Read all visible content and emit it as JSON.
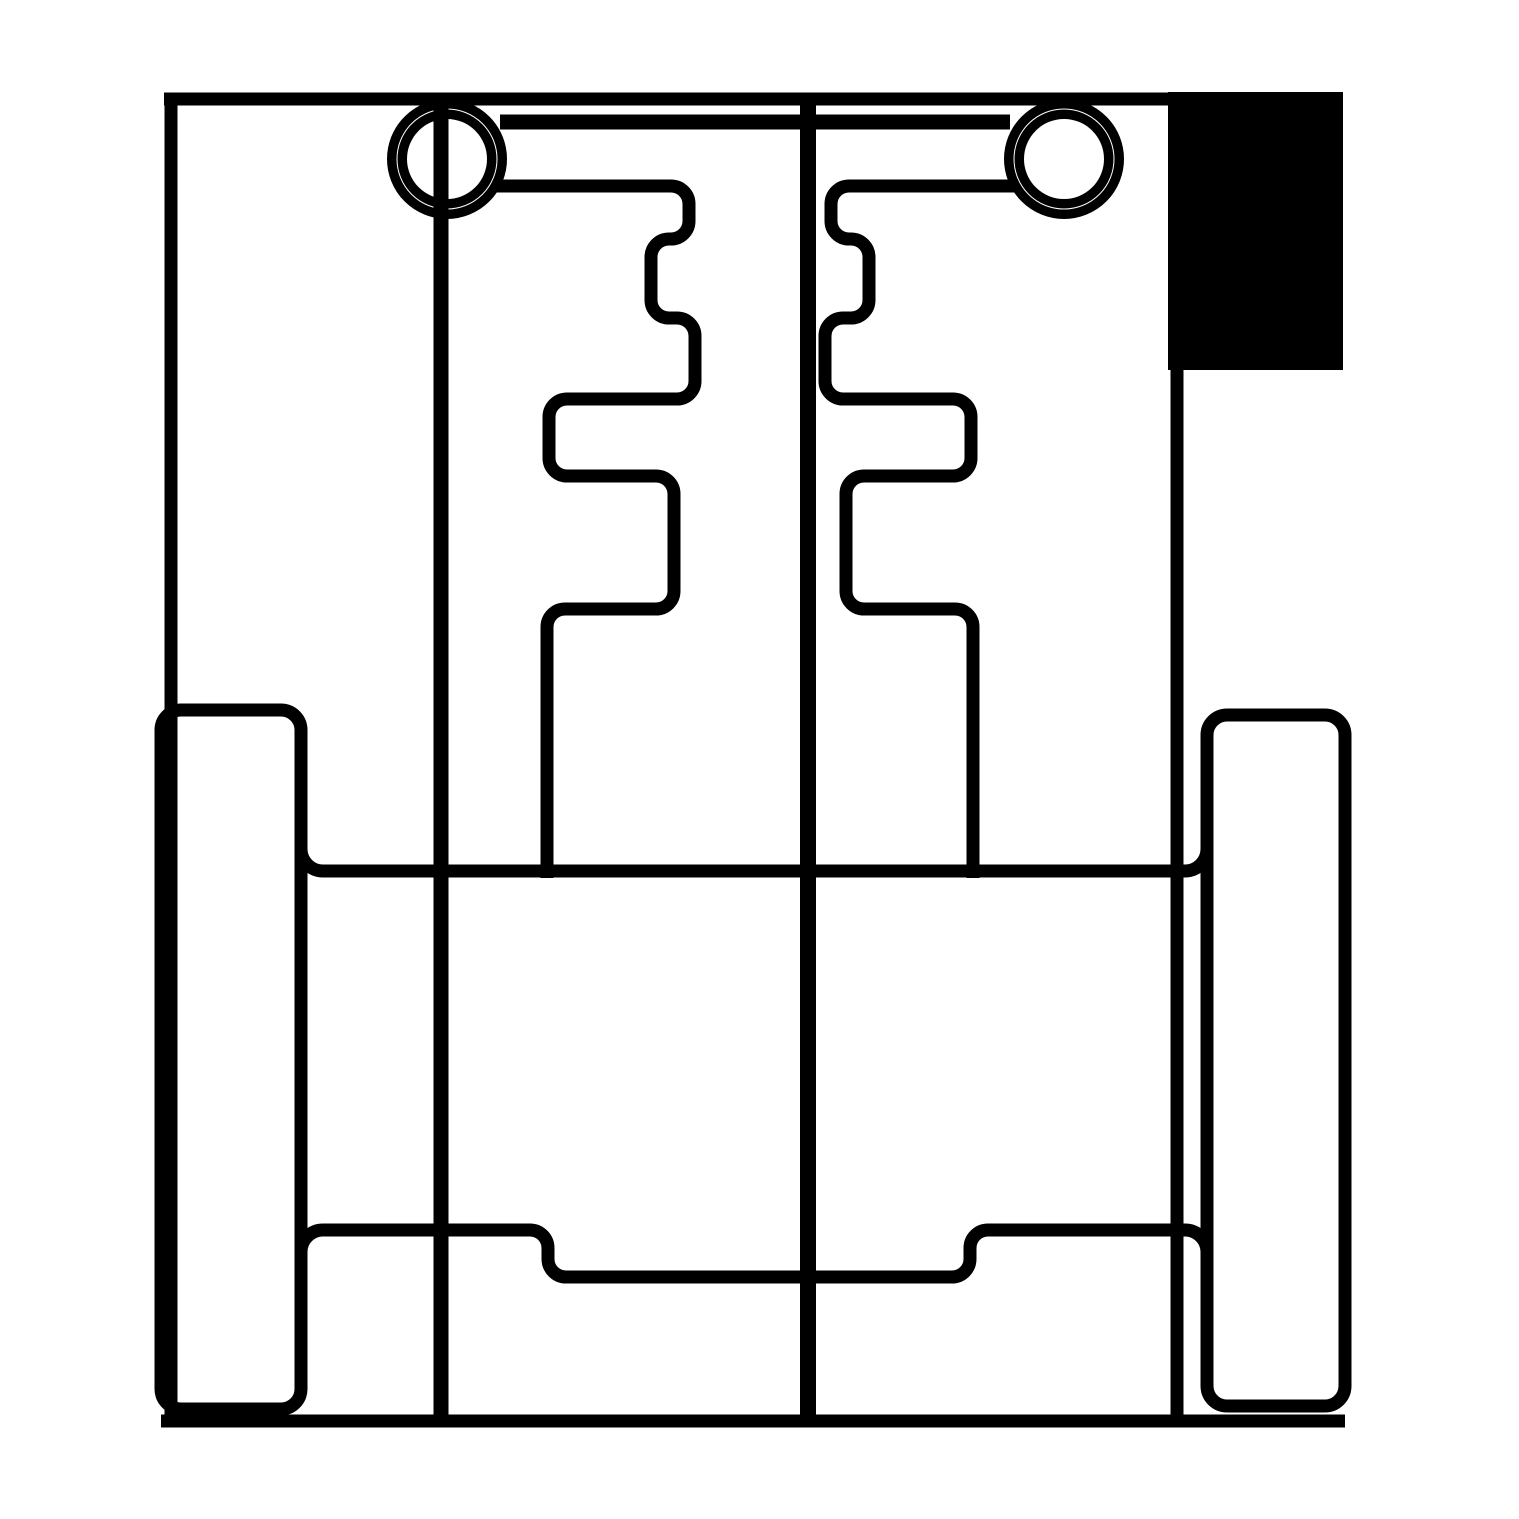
{
  "canvas": {
    "width": 1519,
    "height": 1519,
    "background": "#ffffff",
    "stroke_color": "#000000"
  },
  "drawing": {
    "elements": [
      {
        "name": "outer-frame-top-border",
        "type": "line-path",
        "d": "M 164,99 L 1175,99",
        "stroke_width": 13
      },
      {
        "name": "outer-frame-left-border",
        "type": "line-path",
        "d": "M 171,93 L 171,1421",
        "stroke_width": 13
      },
      {
        "name": "outer-frame-right-border",
        "type": "line-path",
        "d": "M 1177,95 L 1177,1421",
        "stroke_width": 13
      },
      {
        "name": "outer-frame-bottom-border",
        "type": "line-path",
        "d": "M 161,1421 L 1345,1421",
        "stroke_width": 13
      },
      {
        "name": "solid-fill-block",
        "type": "filled-rect",
        "x": 1168,
        "y": 92,
        "w": 175,
        "h": 278
      },
      {
        "name": "left-axle-line",
        "type": "line-path",
        "d": "M 441,96 L 441,1421",
        "stroke_width": 15
      },
      {
        "name": "center-divider-line",
        "type": "line-path",
        "d": "M 808,97 L 808,1421",
        "stroke_width": 16
      },
      {
        "name": "crossbar-line",
        "type": "line-path",
        "d": "M 500,122 L 1010,122",
        "stroke_width": 15
      },
      {
        "name": "left-pivot-ring",
        "type": "ring",
        "cx": 447,
        "cy": 159,
        "radii": [
          44.75,
          55.25
        ],
        "stroke_width": 9.5
      },
      {
        "name": "right-pivot-ring",
        "type": "ring",
        "cx": 1064,
        "cy": 159,
        "radii": [
          44.75,
          55.25
        ],
        "stroke_width": 9.5
      },
      {
        "name": "left-gate-path",
        "type": "line-path",
        "d": "M 495,186 L 671,186 A 18 18 0 0 1 689,204 L 689,221 A 18 18 0 0 1 671,239 L 669,239 A 18 18 0 0 0 651,257 L 651,300 A 18 18 0 0 0 669,318 L 677,318 A 18 18 0 0 1 695,336 L 695,381 A 18 18 0 0 1 677,399 L 567,399 A 18 18 0 0 0 549,417 L 549,458 A 18 18 0 0 0 567,476 L 656,476 A 18 18 0 0 1 674,494 L 674,591 A 18 18 0 0 1 656,609 L 565,609 A 18 18 0 0 0 547,627 L 547,878",
        "stroke_width": 13
      },
      {
        "name": "right-gate-path",
        "type": "line-path",
        "d": "M 1016,186 L 849,186 A 18 18 0 0 0 831,204 L 831,221 A 18 18 0 0 0 849,239 L 851,239 A 18 18 0 0 1 869,257 L 869,300 A 18 18 0 0 1 851,318 L 843,318 A 18 18 0 0 0 825,336 L 825,381 A 18 18 0 0 0 843,399 L 953,399 A 18 18 0 0 1 971,417 L 971,458 A 18 18 0 0 1 953,476 L 864,476 A 18 18 0 0 0 846,494 L 846,591 A 18 18 0 0 0 864,609 L 955,609 A 18 18 0 0 1 973,627 L 973,878",
        "stroke_width": 13
      },
      {
        "name": "mid-rail-line",
        "type": "line-path",
        "d": "M 301,849 A 22 22 0 0 0 323,871 L 1185,871 A 22 22 0 0 0 1207,849",
        "stroke_width": 13
      },
      {
        "name": "lower-step-rail",
        "type": "line-path",
        "d": "M 301,1252 A 22 22 0 0 1 323,1230 L 530,1230 A 18 18 0 0 1 548,1248 L 548,1259 A 18 18 0 0 0 566,1277 L 952,1277 A 18 18 0 0 0 970,1259 L 970,1248 A 18 18 0 0 1 988,1230 L 1185,1230 A 22 22 0 0 1 1207,1252",
        "stroke_width": 13
      },
      {
        "name": "left-runner-bar",
        "type": "rounded-rect",
        "x": 161,
        "y": 710,
        "w": 140,
        "h": 699,
        "rx": 20,
        "stroke_width": 13
      },
      {
        "name": "right-runner-bar",
        "type": "rounded-rect",
        "x": 1207,
        "y": 715,
        "w": 138,
        "h": 691,
        "rx": 20,
        "stroke_width": 13
      }
    ]
  }
}
